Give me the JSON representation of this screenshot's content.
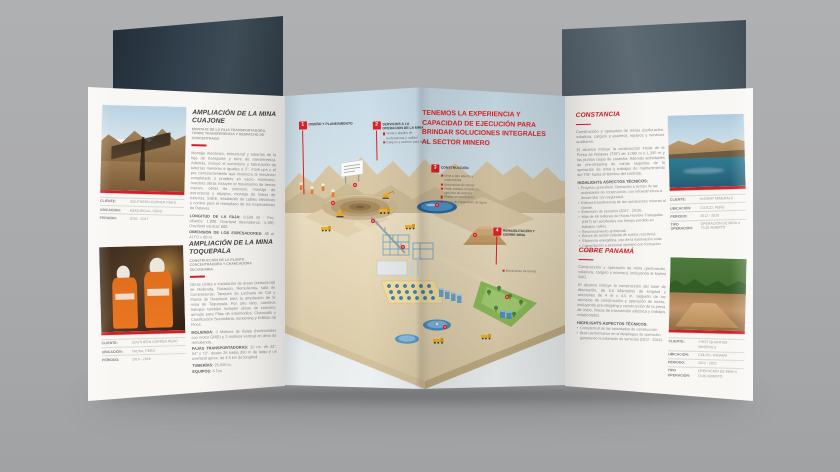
{
  "colors": {
    "accent_red": "#cf2127",
    "headline_red": "#e0252a",
    "background_gray": "#a9aaac"
  },
  "left_panel": {
    "sections": [
      {
        "title": "AMPLIACIÓN DE LA MINA CUAJONE",
        "subtitle": "MONTAJE DE LA FAJA TRANSPORTADORA, TORRE TRANSFERENCIA Y DESPACHO DE CONCENTRADO",
        "body": "Montaje mecánico, estructural y tuberías de la faja de transporte y torre de transferencia. Además, incluyó el suministro y fabricación de tuberías menores e iguales a 2\", mark-ups y el pre comisionamiento que involucra al mecánico completado y pruebas en vacío. Asimismo, nuestras obras incluyen el movimiento de tierras masivo, obras de concreto, montaje de estructuras y equipos, montaje de líneas de tuberías, SSEE, instalación de cables eléctricos y control para el reemplazo de los Espesadores de Relaves.",
        "stats": [
          {
            "label": "LONGITUD DE LA FAJA:",
            "value": "8,530 ml · Pre-ciliados: 1,900. Overland desviaderos: 4,100. Overland vertical: 800."
          },
          {
            "label": "DIMENSIÓN DE LOS ESPESADORES:",
            "value": "36 m ALTO x 80 m."
          }
        ],
        "details": [
          {
            "label": "CLIENTE:",
            "value": "SOUTHERN COPPER PERÚ"
          },
          {
            "label": "UBICACIÓN:",
            "value": "MOQUEGUA, PERÚ"
          },
          {
            "label": "PERIODO:",
            "value": "2016 - 2017"
          }
        ]
      },
      {
        "title": "AMPLIACIÓN DE LA MINA TOQUEPALA",
        "subtitle": "CONSTRUCCIÓN DE LA PLANTA CONCENTRADORA Y CHANCADORA SECUNDARIA",
        "body": "Obras civiles e instalación de áreas (estructural) de Molienda, Flotación, Remolienda, sala de Compresoras, Tanques de Lechada de Cal y Planta de Reactivos para la ampliación de la mina de Toquepala. Por otro lado, nuestros trabajos también incluyen obras de concreto armado para Pilas de intermedios, Chancado y Clasificación Secundaria, Screening y Edificio de Finos.",
        "stats": [
          {
            "label": "MOLIENDA:",
            "value": "3 Molinos de Bolas (horizontales con motor GMD) y 3 molinos vertical en área de remolienda."
          },
          {
            "label": "FAJAS TRANSPORTADORAS:",
            "value": "10 un. de 42\", 54\" y 72\", desde 25 hasta 250 m de largo y un overland aprox. de 4.5 km de longitud."
          },
          {
            "label": "TUBERÍAS:",
            "value": "25,000 m."
          },
          {
            "label": "EQUIPOS:",
            "value": "4 Ton."
          }
        ],
        "details": [
          {
            "label": "CLIENTE:",
            "value": "SOUTHERN COPPER PERÚ"
          },
          {
            "label": "UBICACIÓN:",
            "value": "TACNA, PERÚ"
          },
          {
            "label": "PERIODO:",
            "value": "2016 - 2019"
          }
        ]
      }
    ]
  },
  "center": {
    "headline": "TENEMOS LA EXPERIENCIA Y CAPACIDAD DE EJECUCIÓN PARA BRINDAR SOLUCIONES INTEGRALES AL SECTOR MINERO",
    "markers": [
      {
        "num": "1",
        "title": "DISEÑO Y PLANEAMIENTO",
        "items": []
      },
      {
        "num": "2",
        "title": "SERVICIOS A LA OPERACIÓN DE LA MINA",
        "items": [
          "Venta y alquiler de perforadoras y rodillos",
          "Carguío y acarreo para minas"
        ]
      },
      {
        "num": "3",
        "title": "CONSTRUCCIÓN",
        "items": [
          "Mina a tajo abierto y subterránea",
          "Movimiento de tierras",
          "Pads, presas, botaderos, caminos de acarreo",
          "Planta concentradora",
          "Planta de tratamiento de agua"
        ]
      },
      {
        "num": "4",
        "title": "REHABILITACIÓN Y CIERRE MINA",
        "items": [
          "Movimiento de tierras"
        ]
      }
    ]
  },
  "right_panel": {
    "sections": [
      {
        "title": "CONSTANCIA",
        "paragraphs": [
          "Construcción y operación de minas (perforación, voladura, carguío y acarreo), equipos y servicios auxiliares.",
          "El alcance incluye la construcción inicial de la Presa de Relaves (TSF) de 1,080 m y 1,350 m y los puntos bajos de cosecha. Además actividades de pre-stripping de minas seguidas de la operación de mina y trabajos de mantenimiento del TSF hasta el término del contrato."
        ],
        "highlights_title": "HIGHLIGHTS ASPECTOS TÉCNICOS:",
        "highlights": [
          "Proyecto greenfield. Operación a tiempo de las actividades de construcción, con infraestructura a desarrollar con seguridad.",
          "Exitosa transferencia de las operaciones mineras al cliente.",
          "Extensión de servicios (2017 - 2019).",
          "Más de 45 millones de Horas Hombre Trabajadas (HHT) sin accidentes con tiempo perdido en trabajos civiles.",
          "Reconocimiento ambiental.",
          "Bonos de acción (planta de suelos reactivos).",
          "Eficiencia energética, uso de la iluminación solar.",
          "Capacitación a personal operario con formación continua."
        ],
        "details": [
          {
            "label": "CLIENTE:",
            "value": "HUDBAY MINERALS"
          },
          {
            "label": "UBICACIÓN:",
            "value": "CUSCO, PERÚ"
          },
          {
            "label": "PERIODO:",
            "value": "2012 - 2016"
          },
          {
            "label": "TIPO OPERACIÓN:",
            "value": "OPERACIÓN DE MINA A TAJO ABIERTO"
          }
        ]
      },
      {
        "title": "COBRE PANAMÁ",
        "paragraphs": [
          "Construcción y operación de mina (perforación, voladura, carguío y acarreo), incluyendo el Molino SAG.",
          "El alcance incluye la construcción del túnel de desviación, de 5.5 kilómetros de longitud y secciones de 4 m x 4.5 m. Seguido de los servicios de construcción y operación de minas, incluyendo pre-stripping y construcción de la presa de inicio, líneas de transmisión eléctrica y trabajos relacionados."
        ],
        "highlights_title": "HIGHLIGHTS ASPECTOS TÉCNICOS:",
        "highlights": [
          "Completitud de las actividades de construcción.",
          "Buen performance en el despliegue de operación generando la extensión de servicios (2012 - 2016)."
        ],
        "details": [
          {
            "label": "CLIENTE:",
            "value": "FIRST QUANTUM MINERALS"
          },
          {
            "label": "UBICACIÓN:",
            "value": "COLÓN, PANAMÁ"
          },
          {
            "label": "PERIODO:",
            "value": "2012 - 2022"
          },
          {
            "label": "TIPO OPERACIÓN:",
            "value": "OPERACIÓN DE MINA A TAJO ABIERTO"
          }
        ]
      }
    ]
  }
}
